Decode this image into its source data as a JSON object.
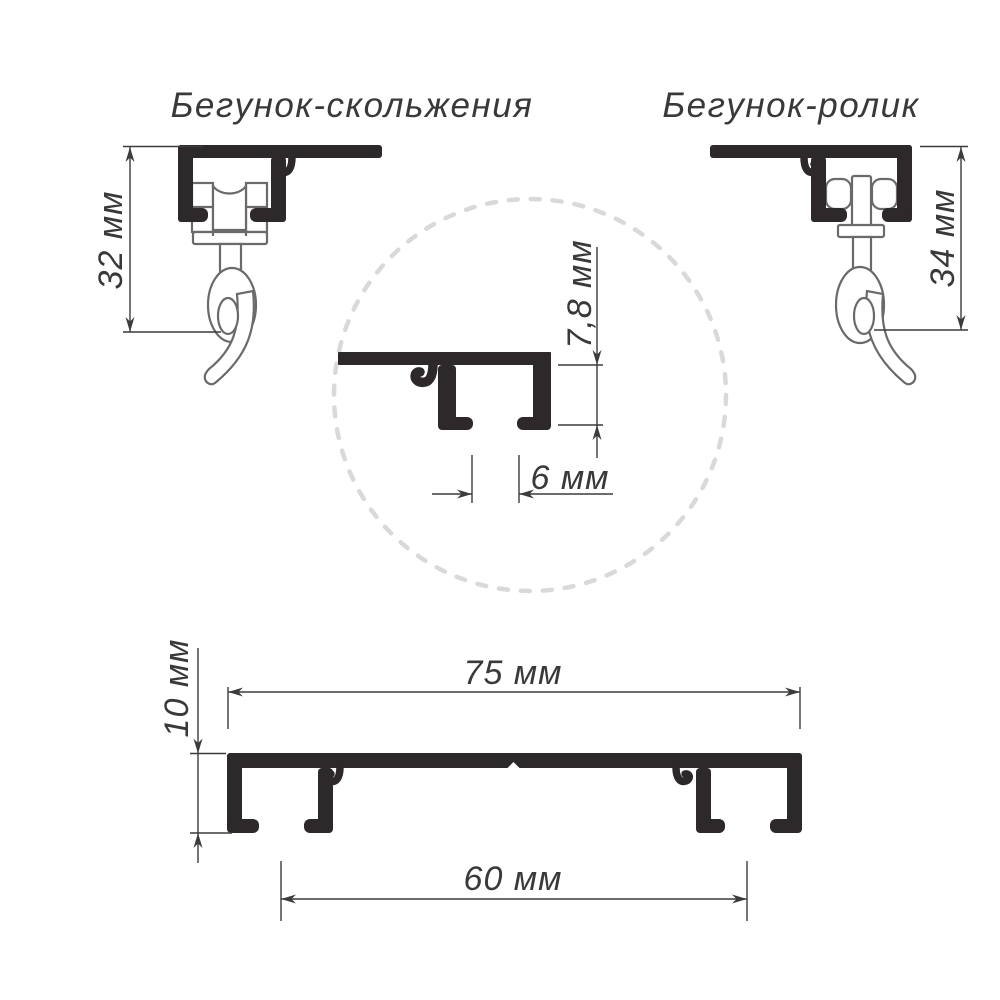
{
  "titles": {
    "runner_glide": "Бегунок-скольжения",
    "runner_roller": "Бегунок-ролик"
  },
  "dimensions": {
    "runner_glide_height": "32 мм",
    "runner_roller_height": "34 мм",
    "detail_groove_depth": "7,8 мм",
    "detail_groove_width": "6 мм",
    "profile_height": "10 мм",
    "profile_width": "75 мм",
    "groove_spacing": "60 мм"
  },
  "colors": {
    "profile_fill": "#2d292a",
    "runner_outline": "#6a6a6a",
    "dimension_line": "#3c3c3e",
    "text": "#39393b",
    "detail_circle": "#d9d9d9"
  }
}
